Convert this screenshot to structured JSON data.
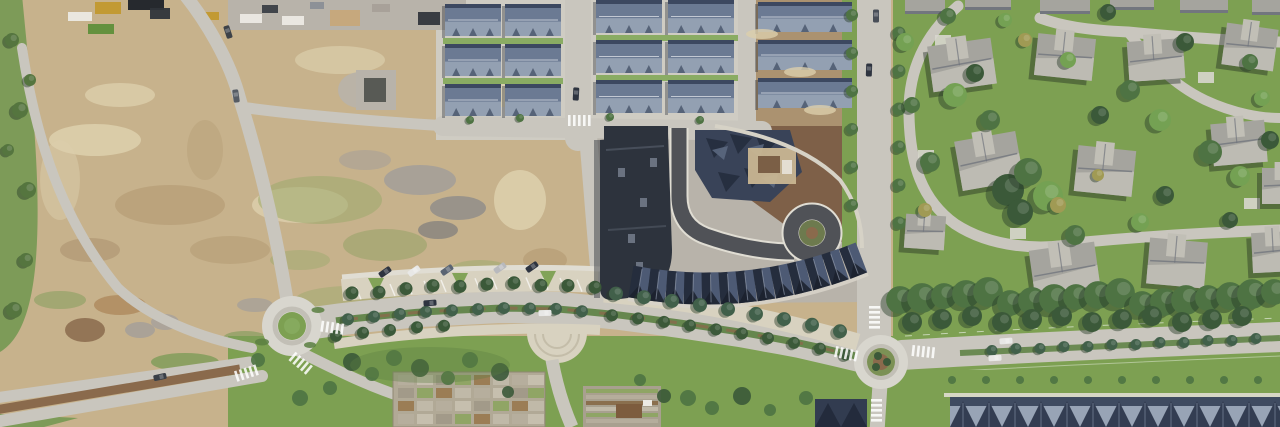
{
  "image": {
    "title": "Aerial photograph of a suburban development: construction site, new townhouses, boulevard with two roundabouts, community gardens and an established tree-lined neighborhood",
    "width_px": 1280,
    "height_px": 427
  },
  "scene": {
    "regions": [
      {
        "id": "construction-site",
        "label": "Graded bare-earth construction site with equipment, rubble piles and access roads",
        "position": "top-left"
      },
      {
        "id": "left-vegetation",
        "label": "Scrubby green vegetation strip along the left edge",
        "position": "left"
      },
      {
        "id": "townhouse-district",
        "label": "Rows of new townhouses with blue-gray hip roofs on a street grid",
        "position": "top-center"
      },
      {
        "id": "apartment-complex",
        "label": "Large dark flat-roofed building and navy gabled townhouse row under construction with a teardrop courtyard drive and circular island",
        "position": "center"
      },
      {
        "id": "established-neighborhood",
        "label": "Mature neighborhood of large detached houses among dense trees with winding streets",
        "position": "right"
      },
      {
        "id": "main-boulevard",
        "label": "Divided boulevard with planted medians, double rows of street trees, angled parking and paver plazas",
        "position": "center-bottom"
      },
      {
        "id": "west-roundabout",
        "label": "Roundabout with grassy center island",
        "position": "bottom-left"
      },
      {
        "id": "east-roundabout",
        "label": "Roundabout with planted brown center island",
        "position": "bottom-right"
      },
      {
        "id": "semicircular-plaza",
        "label": "Semicircular stepped paver plaza on the south edge of the boulevard",
        "position": "bottom-center"
      },
      {
        "id": "community-gardens",
        "label": "Grid of rectangular community-garden plots with central path and sheds",
        "position": "bottom-center"
      },
      {
        "id": "park-greenway",
        "label": "Green park strip with shrub beds between boulevard and gardens",
        "position": "bottom"
      },
      {
        "id": "south-townhouse-row",
        "label": "Continuous row of gabled townhouse roofs along the bottom edge",
        "position": "bottom-right"
      }
    ],
    "counts": {
      "roundabouts": 2,
      "visible_vehicles": 14
    }
  },
  "palette": {
    "dirt_mid": "#c7b28c",
    "dirt_light": "#dcceab",
    "dirt_dark": "#ab9270",
    "dirt_brown": "#8a6a4c",
    "earth_red": "#7e6048",
    "rubble": "#a6a098",
    "gravel": "#b8b3aa",
    "road": "#c9c6be",
    "road_bright": "#d8d6ce",
    "asphalt": "#505257",
    "paver": "#d8d2c0",
    "walk": "#e0ddd3",
    "concrete": "#cfccc3",
    "grass": "#7da052",
    "grass_dark": "#5b7f41",
    "scrub": "#7d9b58",
    "lawn": "#86aa5e",
    "tree_dark": "#3b5939",
    "tree_mid": "#4e7343",
    "tree_light": "#74a153",
    "tree_olive": "#a09a54",
    "shadow_green": "#273b28",
    "roof_light": "#98a4b6",
    "roof_mid": "#6b7a93",
    "roof_dark": "#3c4860",
    "roof_deep": "#232b3c",
    "flat_roof": "#2d333d",
    "house_light": "#c1bfb6",
    "house_mid": "#a5a49e",
    "house_dark": "#72767e",
    "wall": "#e6e0d1",
    "white": "#eceae4",
    "car_dark": "#2e3440",
    "car_white": "#e8e8e6"
  }
}
